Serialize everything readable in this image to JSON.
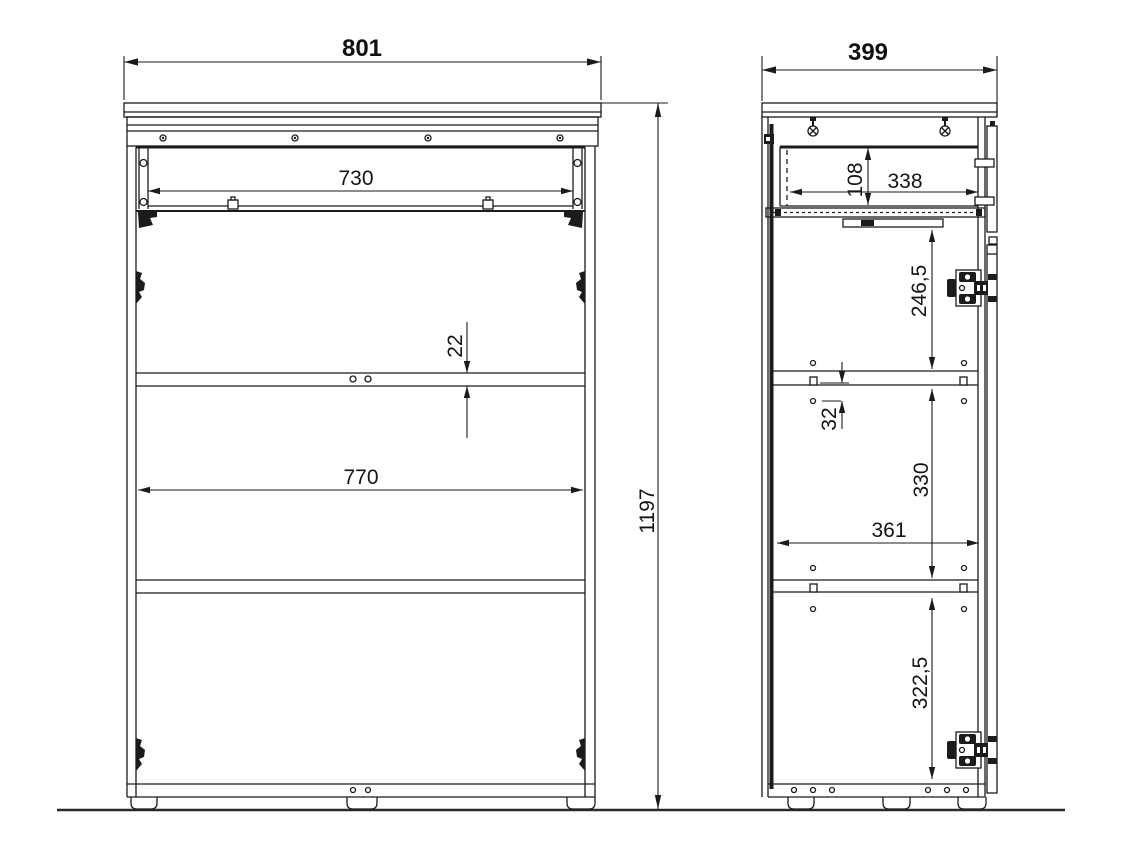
{
  "drawing": {
    "background_color": "#ffffff",
    "line_color": "#1b1b1b",
    "front_view": {
      "overall_width": "801",
      "drawer_clear_width": "730",
      "shelf_thickness": "22",
      "interior_width": "770",
      "overall_height": "1197"
    },
    "side_view": {
      "overall_depth": "399",
      "drawer_clear_height": "108",
      "drawer_clear_depth": "338",
      "upper_section_height": "246,5",
      "row_hole_pitch": "32",
      "middle_section_height": "330",
      "interior_depth": "361",
      "lower_section_height": "322,5"
    }
  }
}
